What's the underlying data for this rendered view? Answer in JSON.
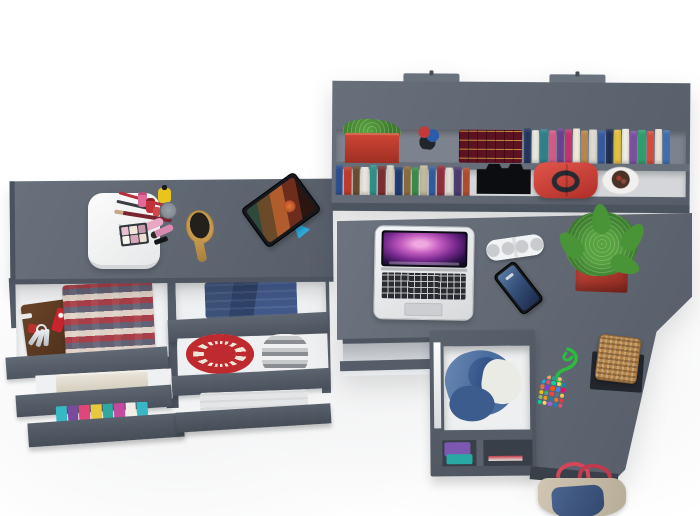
{
  "scene": {
    "type": "3d-furniture-render-top-view",
    "description": "Top-down 3D render of a teen bedroom furniture set: vanity dresser with open drawers, wall-mounted bookshelf, corner desk with laptop and accessories, under-desk drawer unit, wicker basket and tote bag.",
    "background": "#ffffff",
    "palette": {
      "furniture_gray": "#5c6470",
      "furniture_gray_dark": "#4a515c",
      "furniture_edge": "#4c5660",
      "drawer_interior": "#f1f2f3",
      "shelf_back_upper": "#7d838e",
      "shelf_back_lower": "#d4d6d9",
      "accent_red": "#c0392b",
      "pot_red": "#b5382e",
      "plant_green": "#4a9438",
      "denim_blue": "#4a6da0",
      "wicker_tan": "#b5854a",
      "stand_blue": "#2da8d8"
    },
    "vanity": {
      "label": "Vanity dresser top with open drawers",
      "jewelry_box": {
        "label": "White rounded jewelry box",
        "mark": "×",
        "color": "#f2f2f2"
      },
      "makeup_set": {
        "label": "Makeup set: pencils, nail polish bottles, yellow bottle, cream jar, lip gloss tubes, eyeshadow palette",
        "eyeshadow_shades": [
          "#e9c2cf",
          "#f2e6dc",
          "#c79aae",
          "#f8f4ee",
          "#d8a8ba",
          "#efdfd3"
        ]
      },
      "hairbrush": {
        "label": "Wooden oval hairbrush",
        "color": "#c69a4e"
      },
      "tablet": {
        "label": "Tablet on blue stand playing a movie with red-haired character",
        "stand_color": "#2da8d8"
      },
      "drawers_left": [
        {
          "contents": [
            "brown leather key organizer",
            "keys on ring",
            "red pocket knife",
            "red square charm",
            "folded red-white plaid shirt"
          ]
        },
        {
          "contents": [
            "folded beige towel"
          ]
        },
        {
          "contents": [
            "stack of colorful folded shirts"
          ],
          "stripe_colors": [
            "#36b9c5",
            "#7a4a9e",
            "#e0467a",
            "#e8c83c",
            "#2fa8a0",
            "#c44a9e",
            "#f0eee6",
            "#36b9c5"
          ]
        }
      ],
      "drawers_right": [
        {
          "contents": [
            "folded blue jeans"
          ]
        },
        {
          "contents": [
            "red crochet round mat",
            "rolled gray plaid fabric"
          ]
        },
        {
          "contents": [
            "folded light gray fabric"
          ]
        }
      ]
    },
    "wall_shelf": {
      "label": "Wall-mounted bookshelf with two rows",
      "upper_items": [
        "red planter with green plant",
        "small toy figurine",
        "maroon gilded book set",
        "row of colorful books"
      ],
      "lower_items": [
        "row of colorful books",
        "black folded headphones",
        "red handbag with dark handles",
        "white bowl planter"
      ],
      "upper_spines": [
        "#24365d",
        "#e9e7e1",
        "#2f808b",
        "#d9588b",
        "#6b4090",
        "#c83070",
        "#f0e9d9",
        "#b9894b",
        "#dedad1",
        "#345a9f",
        "#202e53",
        "#e4c33d",
        "#f1ede5",
        "#7b50a1",
        "#2f9f6c",
        "#d94b3b",
        "#e9e3d7",
        "#3b70b1"
      ],
      "lower_spines": [
        "#2b4e90",
        "#c13a2c",
        "#6b4b2f",
        "#e9e5db",
        "#2f908b",
        "#7b2f2f",
        "#d9d3c5",
        "#203b6f",
        "#8b6b3b",
        "#3b8b4b",
        "#c3b99f",
        "#2f5d9f",
        "#902f3b",
        "#e1ddd3",
        "#4b3b6f",
        "#b14b2f"
      ]
    },
    "desk": {
      "label": "Gray corner desk",
      "laptop": {
        "label": "Open silver laptop with purple aurora wallpaper and dock"
      },
      "speaker": {
        "label": "White pill bluetooth speaker with four grilles"
      },
      "phone": {
        "label": "Black smartphone with blue lock screen"
      },
      "succulent": {
        "label": "Green succulent in red square planter",
        "pot_color": "#b5382e"
      },
      "bead_necklace": {
        "label": "Green cord with cluster of multicolor beads",
        "cord_color": "#2dbb3f",
        "bead_colors": [
          "#e63946",
          "#f4a261",
          "#2a9d8f",
          "#e9c46a",
          "#9b5de5",
          "#00bbf9",
          "#ef476f",
          "#06d6a0",
          "#ffd166",
          "#118ab2",
          "#e76f51",
          "#8338ec",
          "#fb5607",
          "#3a86ff",
          "#ff006e",
          "#ffbe0b",
          "#43aa8b",
          "#f94144",
          "#577590",
          "#f9c74f",
          "#90be6d",
          "#f8961e",
          "#277da1",
          "#f3722c",
          "#e63946",
          "#06d6a0",
          "#ffd166",
          "#9b5de5",
          "#118ab2",
          "#ef476f"
        ]
      },
      "wicker_basket": {
        "label": "Square wicker basket on dark mat",
        "color": "#b5854a"
      }
    },
    "underdesk_unit": {
      "label": "Under-desk drawer unit",
      "contents": [
        "open drawer with blue denim robe and white laundry",
        "shelf niche with folded purple and teal clothes and red strip"
      ]
    },
    "tote_bag": {
      "label": "Denim and canvas tote bag with red straps on the floor",
      "strap_color": "#d4465a"
    }
  }
}
